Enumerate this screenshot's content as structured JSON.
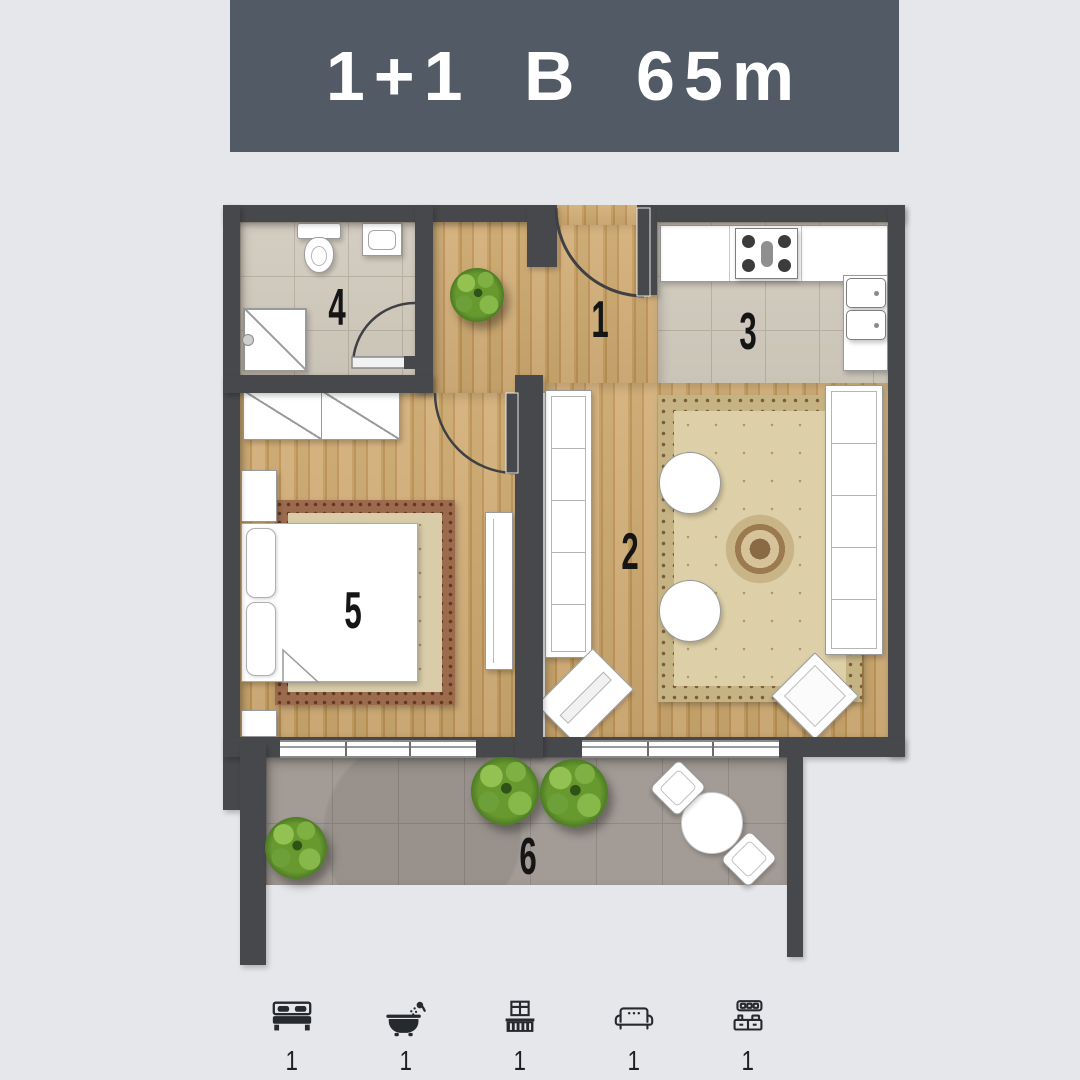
{
  "banner": {
    "title": "1+1 B 65m"
  },
  "plan": {
    "rooms": [
      {
        "label": "1",
        "name": "hall"
      },
      {
        "label": "2",
        "name": "living-room"
      },
      {
        "label": "3",
        "name": "kitchen"
      },
      {
        "label": "4",
        "name": "bathroom"
      },
      {
        "label": "5",
        "name": "bedroom"
      },
      {
        "label": "6",
        "name": "balcony"
      }
    ]
  },
  "amenities": [
    {
      "icon": "bed-icon",
      "count": "1"
    },
    {
      "icon": "bathtub-icon",
      "count": "1"
    },
    {
      "icon": "balcony-icon",
      "count": "1"
    },
    {
      "icon": "sofa-icon",
      "count": "1"
    },
    {
      "icon": "kitchen-icon",
      "count": "1"
    }
  ],
  "colors": {
    "page-bg": "#e6e7ea",
    "banner-bg": "#525a66",
    "banner-text": "#ffffff",
    "wall": "#47484b",
    "wood": "#c9a26a",
    "tile": "#d2cbbe",
    "balcony-floor": "#a39c96",
    "plant-green": "#5b8f31",
    "icon-ink": "#26292e",
    "label-ink": "#151515"
  }
}
